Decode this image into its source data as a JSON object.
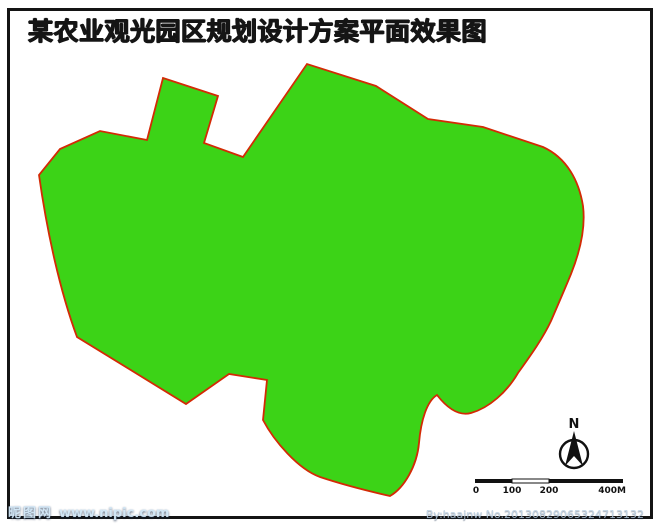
{
  "title": "某农业观光园区规划设计方案平面效果图",
  "map": {
    "north_label": "N",
    "scale": {
      "labels": [
        "0",
        "100",
        "200",
        "400M"
      ]
    }
  },
  "watermarks": {
    "left_brand": "昵图网",
    "left_url": "www.nipic.com",
    "right": "By:haajnw  No.20130829065324713132"
  },
  "colors": {
    "site_green": "#3cd317",
    "light_green": "#6ee832",
    "tree_green": "#1a8a0e",
    "water_blue": "#2a6fe8",
    "road_gray": "#b5b5b5",
    "boundary_red": "#d32a05",
    "field_yellow": "#e6de35",
    "field_red": "#e23434",
    "field_purple": "#8c2fe0",
    "building_brown": "#4a2208",
    "plaza_checker_red": "#cc4a3a"
  }
}
